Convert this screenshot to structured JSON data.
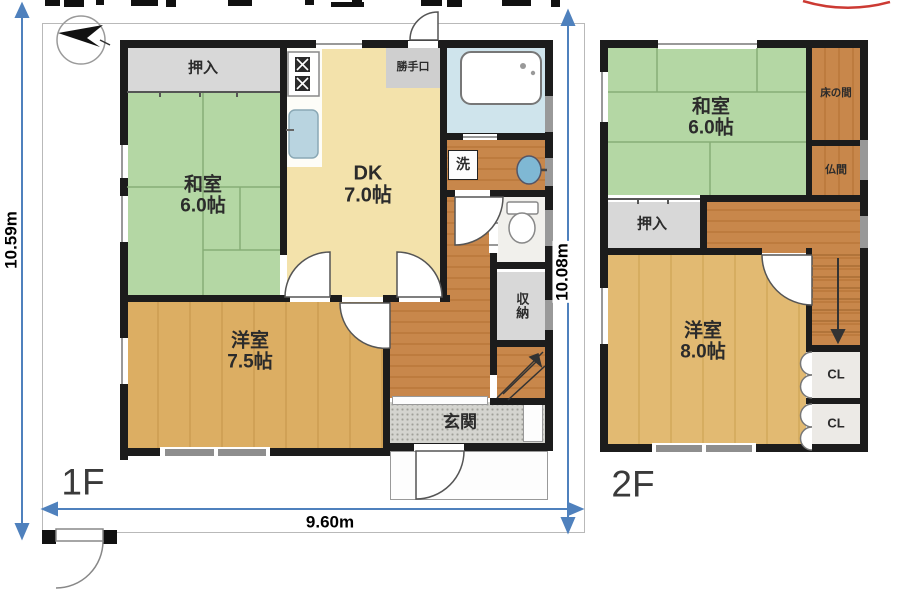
{
  "f1": {
    "label": "1F",
    "oshiire": "押入",
    "washitsu_name": "和室",
    "washitsu_size": "6.0帖",
    "dk_name": "DK",
    "dk_size": "7.0帖",
    "katteguchi": "勝手口",
    "laundry": "洗",
    "storage": "収納",
    "yoshitsu_name": "洋室",
    "yoshitsu_size": "7.5帖",
    "genkan": "玄関"
  },
  "f2": {
    "label": "2F",
    "washitsu_name": "和室",
    "washitsu_size": "6.0帖",
    "tokonoma": "床の間",
    "butsuma": "仏間",
    "oshiire": "押入",
    "yoshitsu_name": "洋室",
    "yoshitsu_size": "8.0帖",
    "cl_upper": "CL",
    "cl_lower": "CL"
  },
  "dimensions": {
    "site_height": "10.59m",
    "building_height": "10.08m",
    "site_width": "9.60m"
  },
  "colors": {
    "tatami_green": "#b4d7a4",
    "wood_dark": "#c8874b",
    "wood_light": "#dcae63",
    "dk_tan": "#f3e2ab",
    "closet_gray": "#d8d8d8",
    "bath_blue": "#cfe4ec",
    "dimension_blue": "#4f81bd",
    "wall_black": "#1c1c1c"
  }
}
